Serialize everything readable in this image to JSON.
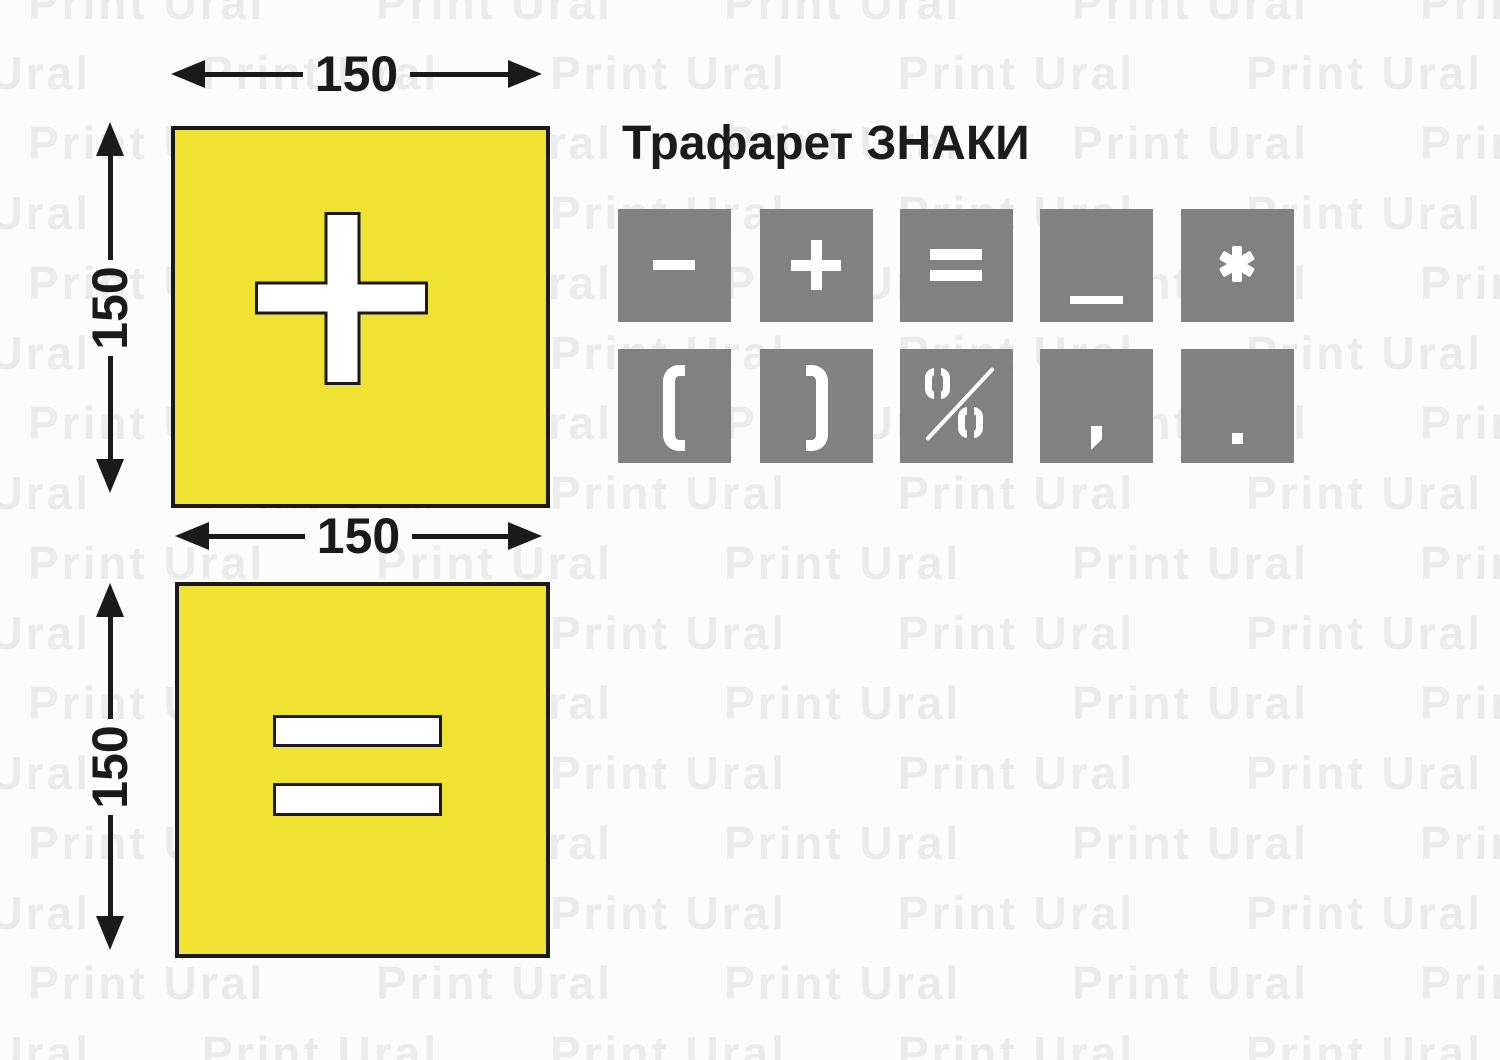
{
  "title": "Трафарет ЗНАКИ",
  "watermark": {
    "text": "Print Ural"
  },
  "colors": {
    "background": "#fcfcfc",
    "watermark": "#ebebeb",
    "stencil_yellow": "#f0e232",
    "tile_gray": "#818181",
    "ink_black": "#1a1a1a",
    "cutout_white": "#ffffff"
  },
  "stencil_plus": {
    "symbol": "plus",
    "width_label": "150",
    "height_label": "150"
  },
  "stencil_equals": {
    "symbol": "equals",
    "width_label": "150",
    "height_label": "150"
  },
  "signs_grid": {
    "row1": [
      "minus",
      "plus",
      "equals",
      "underscore",
      "asterisk"
    ],
    "row2": [
      "paren-open",
      "paren-close",
      "percent",
      "comma",
      "period"
    ]
  }
}
